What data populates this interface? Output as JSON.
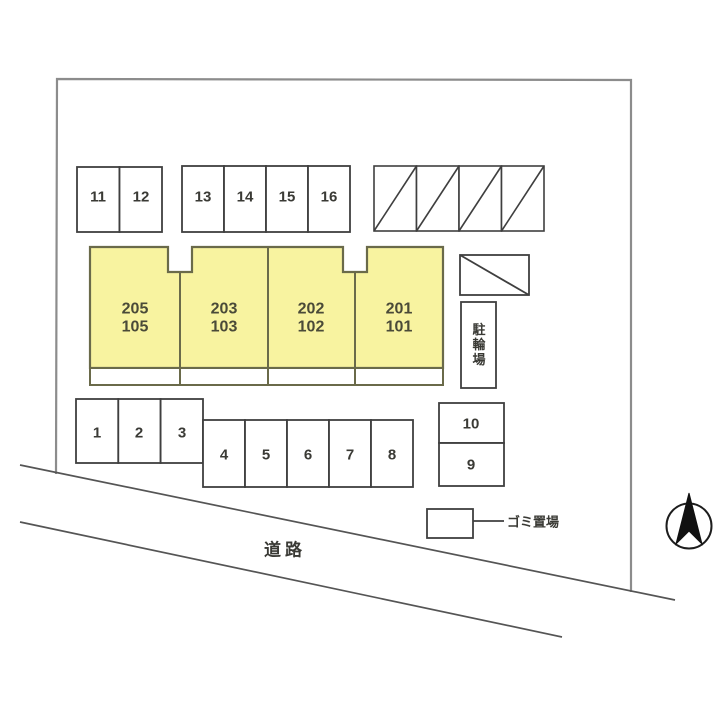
{
  "plan": {
    "building": {
      "units": [
        {
          "upper": "205",
          "lower": "105"
        },
        {
          "upper": "203",
          "lower": "103"
        },
        {
          "upper": "202",
          "lower": "102"
        },
        {
          "upper": "201",
          "lower": "101"
        }
      ]
    },
    "parking_spaces": {
      "top_left_row": [
        "11",
        "12"
      ],
      "top_middle_row": [
        "13",
        "14",
        "15",
        "16"
      ],
      "left_row": [
        "1",
        "2",
        "3"
      ],
      "bottom_middle_row": [
        "4",
        "5",
        "6",
        "7",
        "8"
      ],
      "right_stack": [
        "10",
        "9"
      ],
      "hatched_spaces_count": "4"
    },
    "labels": {
      "bicycle_parking": "駐輪場",
      "garbage_area": "ゴミ置場",
      "road": "道路"
    },
    "compass": {
      "type": "north-arrow"
    },
    "colors": {
      "building_fill": "#f8f3a0",
      "building_stroke": "#6a6a4a",
      "outline": "#3f3f3f",
      "boundary": "#8c8c8c"
    }
  }
}
